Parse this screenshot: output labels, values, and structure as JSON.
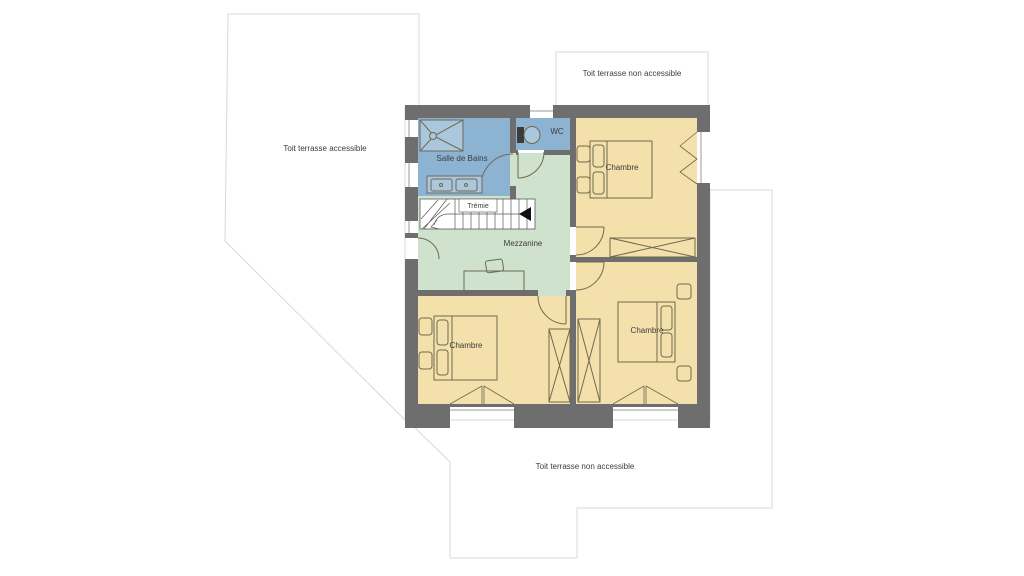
{
  "colors": {
    "wall": "#6e6e6e",
    "bathroom": "#8db3d3",
    "shower": "#aac7de",
    "mezzanine": "#cfe2cd",
    "bedroom": "#f3e0ab",
    "furniture_line": "#6f6a50",
    "terrace_border": "#d9d9d9",
    "text": "#3c3c3c"
  },
  "terraces": {
    "left": {
      "label": "Toit terrasse accessible"
    },
    "top_right": {
      "label": "Toit terrasse non accessible"
    },
    "bottom": {
      "label": "Toit terrasse non accessible"
    }
  },
  "rooms": {
    "bathroom": {
      "label": "Salle de Bains"
    },
    "wc": {
      "label": "WC"
    },
    "stairwell": {
      "label": "Trémie"
    },
    "mezzanine": {
      "label": "Mezzanine"
    },
    "bedroom_top_right": {
      "label": "Chambre"
    },
    "bedroom_bottom_left": {
      "label": "Chambre"
    },
    "bedroom_bottom_right": {
      "label": "Chambre"
    }
  }
}
